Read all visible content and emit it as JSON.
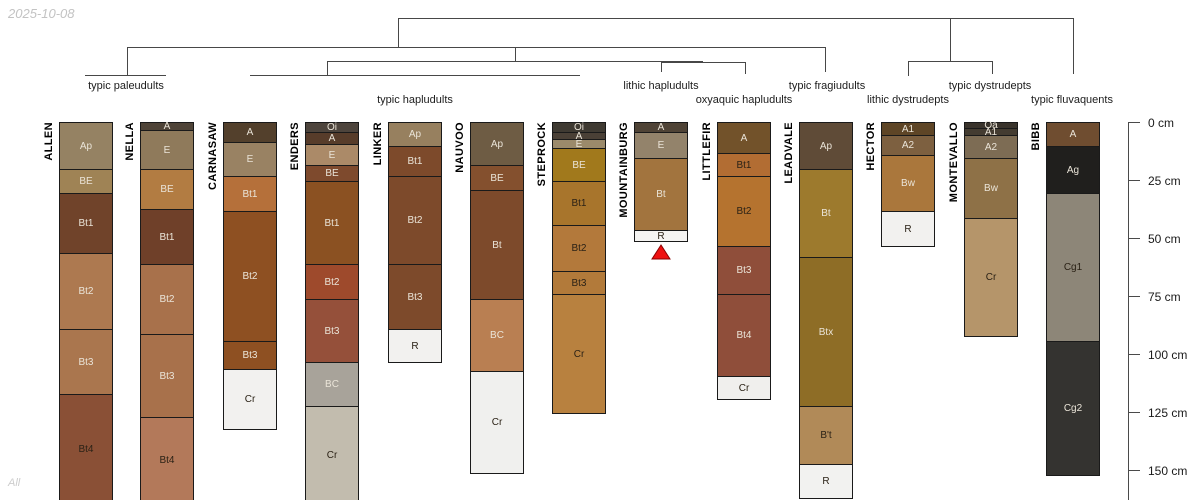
{
  "meta": {
    "date_label": "2025-10-08",
    "footer_label": "All"
  },
  "chart_data": {
    "type": "soil-profile-dendrogram",
    "title": "",
    "depth_axis": {
      "unit": "cm",
      "ticks": [
        0,
        25,
        50,
        75,
        100,
        125,
        150
      ],
      "tick_label_suffix": " cm",
      "axis_x": 1128,
      "tick_len": 12,
      "top_px": 122,
      "px_per_cm": 2.317,
      "axis_bottom_px": 500
    },
    "dendrogram": {
      "line_color": "#474747",
      "segments": [
        {
          "x1": 398,
          "y1": 18,
          "x2": 1073,
          "y2": 18
        },
        {
          "x1": 398,
          "y1": 18,
          "x2": 398,
          "y2": 47
        },
        {
          "x1": 950,
          "y1": 18,
          "x2": 950,
          "y2": 61
        },
        {
          "x1": 1073,
          "y1": 18,
          "x2": 1073,
          "y2": 74
        },
        {
          "x1": 127,
          "y1": 47,
          "x2": 825,
          "y2": 47
        },
        {
          "x1": 127,
          "y1": 47,
          "x2": 127,
          "y2": 75
        },
        {
          "x1": 515,
          "y1": 47,
          "x2": 515,
          "y2": 61
        },
        {
          "x1": 825,
          "y1": 47,
          "x2": 825,
          "y2": 72
        },
        {
          "x1": 327,
          "y1": 61,
          "x2": 703,
          "y2": 61
        },
        {
          "x1": 327,
          "y1": 61,
          "x2": 327,
          "y2": 75
        },
        {
          "x1": 661,
          "y1": 62,
          "x2": 745,
          "y2": 62
        },
        {
          "x1": 661,
          "y1": 62,
          "x2": 661,
          "y2": 72
        },
        {
          "x1": 745,
          "y1": 62,
          "x2": 745,
          "y2": 74
        },
        {
          "x1": 908,
          "y1": 61,
          "x2": 992,
          "y2": 61
        },
        {
          "x1": 908,
          "y1": 61,
          "x2": 908,
          "y2": 76
        },
        {
          "x1": 992,
          "y1": 61,
          "x2": 992,
          "y2": 74
        },
        {
          "x1": 85,
          "y1": 75,
          "x2": 166,
          "y2": 75
        },
        {
          "x1": 250,
          "y1": 75,
          "x2": 580,
          "y2": 75
        }
      ],
      "taxa": [
        {
          "label": "typic paleudults",
          "x": 126,
          "y": 80
        },
        {
          "label": "typic hapludults",
          "x": 415,
          "y": 94
        },
        {
          "label": "lithic hapludults",
          "x": 661,
          "y": 80
        },
        {
          "label": "oxyaquic hapludults",
          "x": 744,
          "y": 94
        },
        {
          "label": "typic fragiudults",
          "x": 827,
          "y": 80
        },
        {
          "label": "lithic dystrudepts",
          "x": 908,
          "y": 94
        },
        {
          "label": "typic dystrudepts",
          "x": 990,
          "y": 80
        },
        {
          "label": "typic fluvaquents",
          "x": 1072,
          "y": 94
        }
      ]
    },
    "profiles": [
      {
        "name": "ALLEN",
        "left": 59,
        "width": 54,
        "horizons": [
          {
            "label": "Ap",
            "top": 0,
            "bottom": 20,
            "color": "#958263",
            "text": "light"
          },
          {
            "label": "BE",
            "top": 20,
            "bottom": 30,
            "color": "#9f8355",
            "text": "light"
          },
          {
            "label": "Bt1",
            "top": 30,
            "bottom": 56,
            "color": "#70432a",
            "text": "light"
          },
          {
            "label": "Bt2",
            "top": 56,
            "bottom": 89,
            "color": "#ad7950",
            "text": "light"
          },
          {
            "label": "Bt3",
            "top": 89,
            "bottom": 117,
            "color": "#aa764e",
            "text": "light"
          },
          {
            "label": "Bt4",
            "top": 117,
            "bottom": 164,
            "color": "#8a5036",
            "text": "dark"
          }
        ]
      },
      {
        "name": "NELLA",
        "left": 140,
        "width": 54,
        "horizons": [
          {
            "label": "A",
            "top": 0,
            "bottom": 3,
            "color": "#4f4438",
            "text": "light"
          },
          {
            "label": "E",
            "top": 3,
            "bottom": 20,
            "color": "#8f7a5b",
            "text": "light"
          },
          {
            "label": "BE",
            "top": 20,
            "bottom": 37,
            "color": "#b27c42",
            "text": "light"
          },
          {
            "label": "Bt1",
            "top": 37,
            "bottom": 61,
            "color": "#6f4029",
            "text": "light"
          },
          {
            "label": "Bt2",
            "top": 61,
            "bottom": 91,
            "color": "#a8714b",
            "text": "light"
          },
          {
            "label": "Bt3",
            "top": 91,
            "bottom": 127,
            "color": "#a8714b",
            "text": "light"
          },
          {
            "label": "Bt4",
            "top": 127,
            "bottom": 164,
            "color": "#b3795a",
            "text": "dark"
          }
        ]
      },
      {
        "name": "CARNASAW",
        "left": 223,
        "width": 54,
        "horizons": [
          {
            "label": "A",
            "top": 0,
            "bottom": 8,
            "color": "#53402c",
            "text": "light"
          },
          {
            "label": "E",
            "top": 8,
            "bottom": 23,
            "color": "#998263",
            "text": "light"
          },
          {
            "label": "Bt1",
            "top": 23,
            "bottom": 38,
            "color": "#b5703a",
            "text": "light"
          },
          {
            "label": "Bt2",
            "top": 38,
            "bottom": 94,
            "color": "#8e5022",
            "text": "light"
          },
          {
            "label": "Bt3",
            "top": 94,
            "bottom": 106,
            "color": "#8e5022",
            "text": "light"
          },
          {
            "label": "Cr",
            "top": 106,
            "bottom": 132,
            "color": "#f2f1ef",
            "text": "dark"
          }
        ]
      },
      {
        "name": "ENDERS",
        "left": 305,
        "width": 54,
        "horizons": [
          {
            "label": "Oi",
            "top": 0,
            "bottom": 4,
            "color": "#4d443c",
            "text": "light"
          },
          {
            "label": "A",
            "top": 4,
            "bottom": 9,
            "color": "#573c2a",
            "text": "light"
          },
          {
            "label": "E",
            "top": 9,
            "bottom": 18,
            "color": "#ab8a68",
            "text": "light"
          },
          {
            "label": "BE",
            "top": 18,
            "bottom": 25,
            "color": "#7e4a2d",
            "text": "light"
          },
          {
            "label": "Bt1",
            "top": 25,
            "bottom": 61,
            "color": "#8b5122",
            "text": "light"
          },
          {
            "label": "Bt2",
            "top": 61,
            "bottom": 76,
            "color": "#9e4a2c",
            "text": "light"
          },
          {
            "label": "Bt3",
            "top": 76,
            "bottom": 103,
            "color": "#95503a",
            "text": "light"
          },
          {
            "label": "BC",
            "top": 103,
            "bottom": 122,
            "color": "#a8a39a",
            "text": "light"
          },
          {
            "label": "Cr",
            "top": 122,
            "bottom": 164,
            "color": "#c2bcae",
            "text": "dark"
          }
        ]
      },
      {
        "name": "LINKER",
        "left": 388,
        "width": 54,
        "horizons": [
          {
            "label": "Ap",
            "top": 0,
            "bottom": 10,
            "color": "#97805f",
            "text": "light"
          },
          {
            "label": "Bt1",
            "top": 10,
            "bottom": 23,
            "color": "#7d4a2b",
            "text": "light"
          },
          {
            "label": "Bt2",
            "top": 23,
            "bottom": 61,
            "color": "#7d4a2b",
            "text": "light"
          },
          {
            "label": "Bt3",
            "top": 61,
            "bottom": 89,
            "color": "#7d4a2b",
            "text": "light"
          },
          {
            "label": "R",
            "top": 89,
            "bottom": 103,
            "color": "#f2f1ef",
            "text": "dark"
          }
        ]
      },
      {
        "name": "NAUVOO",
        "left": 470,
        "width": 54,
        "horizons": [
          {
            "label": "Ap",
            "top": 0,
            "bottom": 18,
            "color": "#6e5c44",
            "text": "light"
          },
          {
            "label": "BE",
            "top": 18,
            "bottom": 29,
            "color": "#84502e",
            "text": "light"
          },
          {
            "label": "Bt",
            "top": 29,
            "bottom": 76,
            "color": "#7d4a2b",
            "text": "light"
          },
          {
            "label": "BC",
            "top": 76,
            "bottom": 107,
            "color": "#b97f52",
            "text": "light"
          },
          {
            "label": "Cr",
            "top": 107,
            "bottom": 151,
            "color": "#f0f0ee",
            "text": "dark"
          }
        ]
      },
      {
        "name": "STEPROCK",
        "left": 552,
        "width": 54,
        "horizons": [
          {
            "label": "Oi",
            "top": 0,
            "bottom": 4,
            "color": "#3f3a32",
            "text": "light"
          },
          {
            "label": "A",
            "top": 4,
            "bottom": 7,
            "color": "#4a4036",
            "text": "light"
          },
          {
            "label": "E",
            "top": 7,
            "bottom": 11,
            "color": "#9b8a6b",
            "text": "light"
          },
          {
            "label": "BE",
            "top": 11,
            "bottom": 25,
            "color": "#a1791c",
            "text": "light"
          },
          {
            "label": "Bt1",
            "top": 25,
            "bottom": 44,
            "color": "#a8752c",
            "text": "dark"
          },
          {
            "label": "Bt2",
            "top": 44,
            "bottom": 64,
            "color": "#b3793b",
            "text": "dark"
          },
          {
            "label": "Bt3",
            "top": 64,
            "bottom": 74,
            "color": "#b27a3a",
            "text": "dark"
          },
          {
            "label": "Cr",
            "top": 74,
            "bottom": 125,
            "color": "#b8813f",
            "text": "dark"
          }
        ]
      },
      {
        "name": "MOUNTAINBURG",
        "left": 634,
        "width": 54,
        "marker": "red-triangle",
        "horizons": [
          {
            "label": "A",
            "top": 0,
            "bottom": 4,
            "color": "#4f4336",
            "text": "light"
          },
          {
            "label": "E",
            "top": 4,
            "bottom": 15,
            "color": "#93836b",
            "text": "light"
          },
          {
            "label": "Bt",
            "top": 15,
            "bottom": 46,
            "color": "#a2743e",
            "text": "light"
          },
          {
            "label": "R",
            "top": 46,
            "bottom": 51,
            "color": "#f5f4f2",
            "text": "dark"
          }
        ]
      },
      {
        "name": "LITTLEFIR",
        "left": 717,
        "width": 54,
        "horizons": [
          {
            "label": "A",
            "top": 0,
            "bottom": 13,
            "color": "#72522a",
            "text": "light"
          },
          {
            "label": "Bt1",
            "top": 13,
            "bottom": 23,
            "color": "#b26d33",
            "text": "dark"
          },
          {
            "label": "Bt2",
            "top": 23,
            "bottom": 53,
            "color": "#b5732f",
            "text": "dark"
          },
          {
            "label": "Bt3",
            "top": 53,
            "bottom": 74,
            "color": "#8f4e3a",
            "text": "light"
          },
          {
            "label": "Bt4",
            "top": 74,
            "bottom": 109,
            "color": "#8f4e3a",
            "text": "light"
          },
          {
            "label": "Cr",
            "top": 109,
            "bottom": 119,
            "color": "#f0efed",
            "text": "dark"
          }
        ]
      },
      {
        "name": "LEADVALE",
        "left": 799,
        "width": 54,
        "horizons": [
          {
            "label": "Ap",
            "top": 0,
            "bottom": 20,
            "color": "#5f4b37",
            "text": "light"
          },
          {
            "label": "Bt",
            "top": 20,
            "bottom": 58,
            "color": "#9d7a2d",
            "text": "light"
          },
          {
            "label": "Btx",
            "top": 58,
            "bottom": 122,
            "color": "#8e6d26",
            "text": "light"
          },
          {
            "label": "B't",
            "top": 122,
            "bottom": 147,
            "color": "#b18a58",
            "text": "dark"
          },
          {
            "label": "R",
            "top": 147,
            "bottom": 162,
            "color": "#f2f2f0",
            "text": "dark"
          }
        ]
      },
      {
        "name": "HECTOR",
        "left": 881,
        "width": 54,
        "horizons": [
          {
            "label": "A1",
            "top": 0,
            "bottom": 5,
            "color": "#5e4526",
            "text": "light"
          },
          {
            "label": "A2",
            "top": 5,
            "bottom": 14,
            "color": "#7d6040",
            "text": "light"
          },
          {
            "label": "Bw",
            "top": 14,
            "bottom": 38,
            "color": "#aa773c",
            "text": "light"
          },
          {
            "label": "R",
            "top": 38,
            "bottom": 53,
            "color": "#f2f1ef",
            "text": "dark"
          }
        ]
      },
      {
        "name": "MONTEVALLO",
        "left": 964,
        "width": 54,
        "horizons": [
          {
            "label": "Oa",
            "top": 0,
            "bottom": 2,
            "color": "#3a342c",
            "text": "light"
          },
          {
            "label": "A1",
            "top": 2,
            "bottom": 5,
            "color": "#443c31",
            "text": "light"
          },
          {
            "label": "A2",
            "top": 5,
            "bottom": 15,
            "color": "#7d6c54",
            "text": "light"
          },
          {
            "label": "Bw",
            "top": 15,
            "bottom": 41,
            "color": "#8e7147",
            "text": "light"
          },
          {
            "label": "Cr",
            "top": 41,
            "bottom": 92,
            "color": "#b5956a",
            "text": "dark"
          }
        ]
      },
      {
        "name": "BIBB",
        "left": 1046,
        "width": 54,
        "horizons": [
          {
            "label": "A",
            "top": 0,
            "bottom": 10,
            "color": "#6f4d30",
            "text": "light"
          },
          {
            "label": "Ag",
            "top": 10,
            "bottom": 30,
            "color": "#201f1d",
            "text": "light"
          },
          {
            "label": "Cg1",
            "top": 30,
            "bottom": 94,
            "color": "#8d8678",
            "text": "dark"
          },
          {
            "label": "Cg2",
            "top": 94,
            "bottom": 152,
            "color": "#343330",
            "text": "light"
          }
        ]
      }
    ],
    "marker_colors": {
      "red_triangle_fill": "#ee1111",
      "red_triangle_stroke": "#8b0000"
    }
  }
}
